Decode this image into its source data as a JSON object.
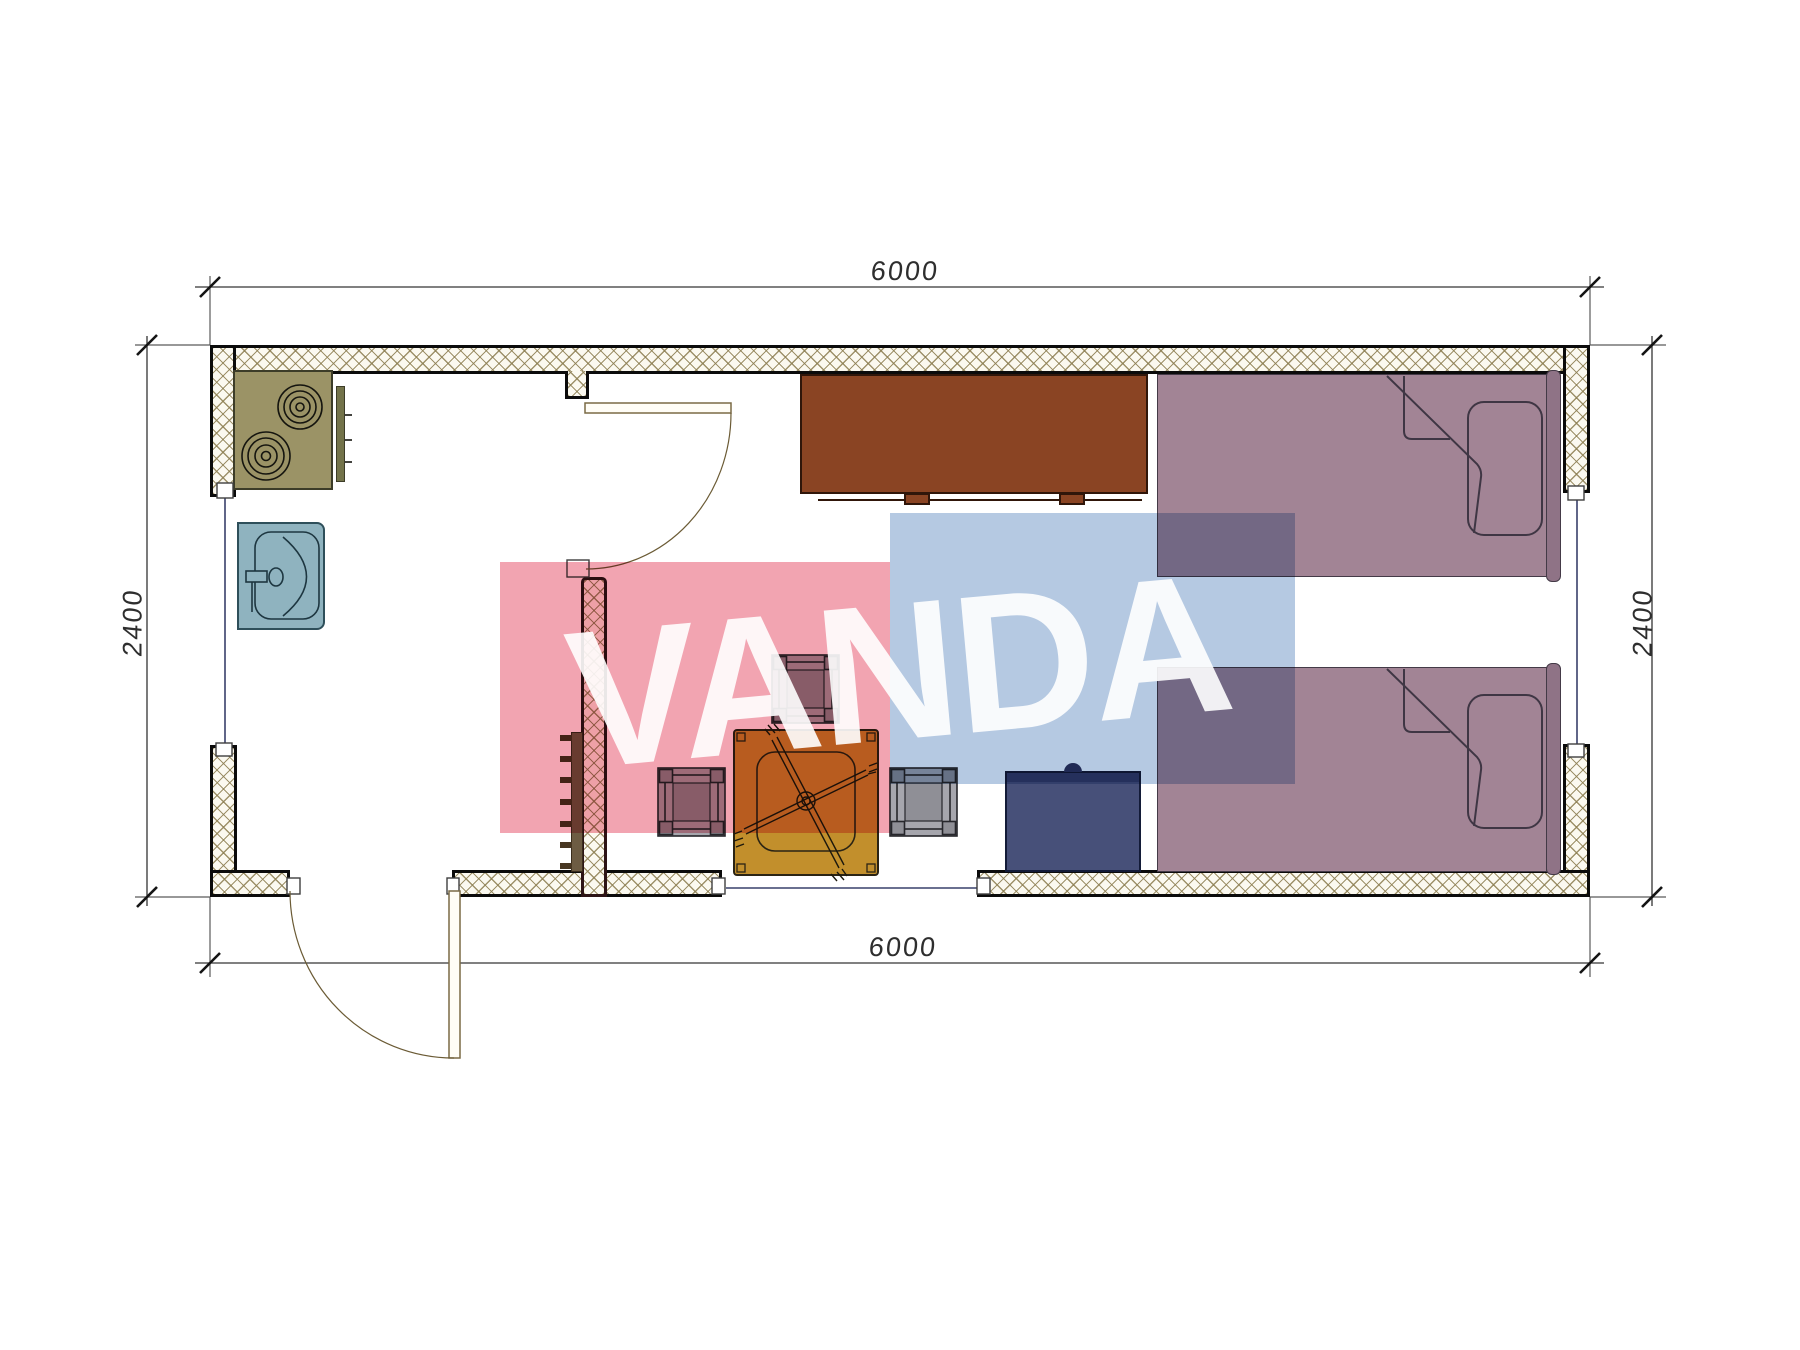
{
  "drawing": {
    "type": "architectural floor plan, 6000x2400 container cabin",
    "dimension_labels": {
      "top": "6000",
      "bottom": "6000",
      "left": "2400",
      "right": "2400"
    },
    "watermark": {
      "text": "VANDA",
      "pink_color": "#f2a4b1",
      "blue_color": "#b5c9e2",
      "text_color": "#ffffff"
    },
    "furniture": [
      {
        "name": "stove-two-burners",
        "color": "#9b9366"
      },
      {
        "name": "kitchen-sink",
        "color": "#8fb3bf"
      },
      {
        "name": "sideboard-cabinet",
        "color": "#8a4423"
      },
      {
        "name": "single-bed-top",
        "color": "#a28495"
      },
      {
        "name": "single-bed-bottom",
        "color": "#a28495"
      },
      {
        "name": "tea-table-with-cross-base",
        "color": "#c28f2c"
      },
      {
        "name": "stool-top",
        "color": "#a6a6ad"
      },
      {
        "name": "stool-left",
        "color": "#a6a6ad"
      },
      {
        "name": "stool-right",
        "color": "#a6a6ad"
      },
      {
        "name": "storage-chest",
        "color": "#475079"
      },
      {
        "name": "wall-shelf-rack",
        "color": "#6d5c43"
      }
    ],
    "wall_hatch_color": "#8d7f52"
  }
}
